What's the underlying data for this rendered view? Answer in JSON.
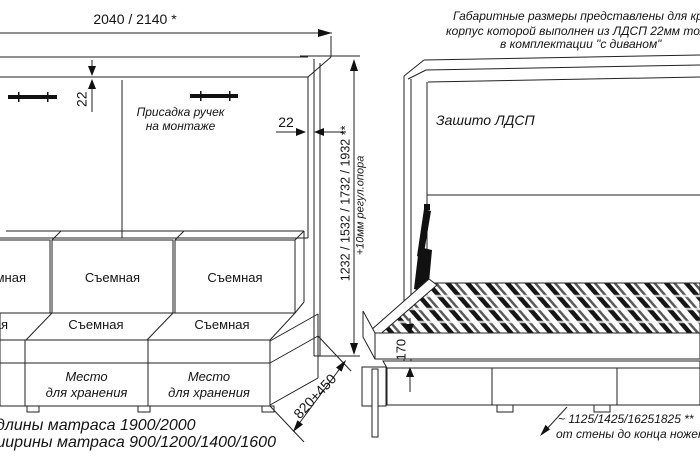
{
  "drawing": {
    "top_note": {
      "line1": "Габаритные размеры представлены для кров",
      "line2": "корпус которой выполнен из ЛДСП 22мм толщ",
      "line3": "в комплектации \"с диваном\""
    },
    "closed_view": {
      "overall_width": "2040 / 2140 *",
      "top_panel_thickness": "22",
      "side_panel_thickness": "22",
      "handles_note_line1": "Присадка ручек",
      "handles_note_line2": "на монтаже",
      "height_dim": "1232 / 1532 / 1732 / 1932 **",
      "support_note": "+10мм регул.опора",
      "depth_dim": "820+450",
      "cushion_label": "Съемная",
      "storage_line1": "Место",
      "storage_line2": "для хранения"
    },
    "open_view": {
      "panel_label": "Зашито ЛДСП",
      "platform_height": "170",
      "wall_note_line1": "~ 1125/1425/16251825 **",
      "wall_note_line2": "от стены до конца ножек"
    },
    "footnotes": {
      "mattress_length": "длины матраса 1900/2000",
      "mattress_width": "ширины матраса 900/1200/1400/1600"
    }
  }
}
